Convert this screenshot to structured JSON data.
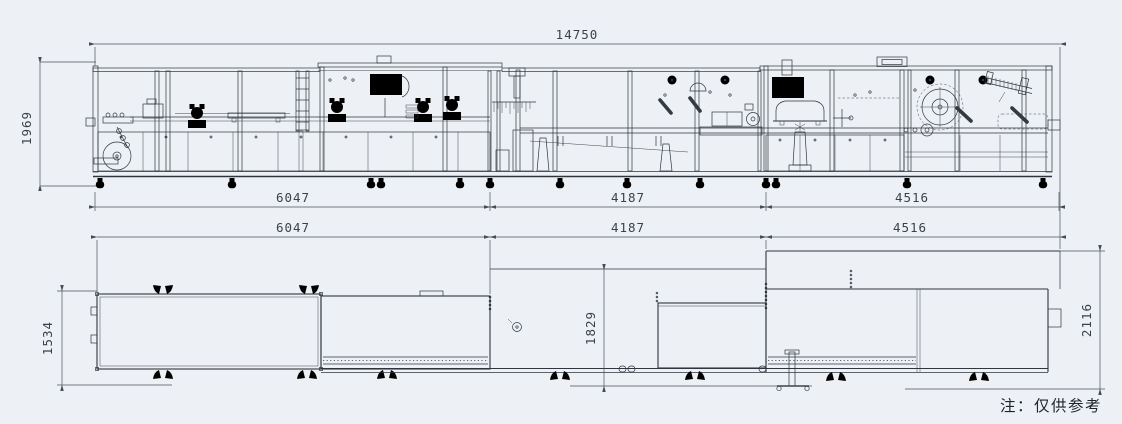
{
  "page": {
    "background_color": "#edf1f6",
    "line_color": "#2f353d",
    "dimension_color": "#4a515c",
    "note": "注：仅供参考"
  },
  "elevation": {
    "overall_length": "14750",
    "overall_height": "1969",
    "segments": [
      "6047",
      "4187",
      "4516"
    ]
  },
  "plan": {
    "segments": [
      "6047",
      "4187",
      "4516"
    ],
    "depth_left": "1534",
    "depth_middle": "1829",
    "depth_right": "2116"
  }
}
